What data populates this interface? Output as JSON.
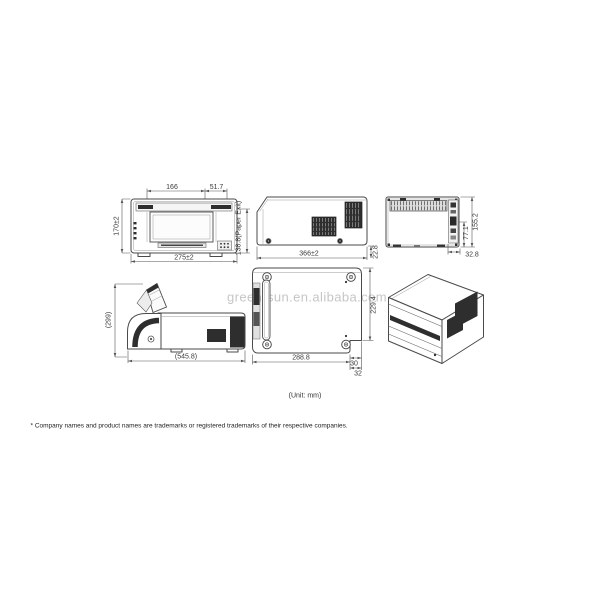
{
  "watermark": "green-sun.en.alibaba.com",
  "unit_label": "(Unit: mm)",
  "footnote": "* Company names and product names are trademarks or registered trademarks of their respective companies.",
  "views": {
    "front": {
      "dims": {
        "opening_width": "166",
        "opening_right": "51.7",
        "height": "170±2",
        "width": "275±2",
        "paper_exit": "138.8(Paper Exit)"
      }
    },
    "side": {
      "dims": {
        "depth": "366±2",
        "rear_step": "22.8"
      }
    },
    "rear": {
      "dims": {
        "height": "155.2",
        "connector": "77.1",
        "side_step": "32.8"
      }
    },
    "side_open": {
      "dims": {
        "height": "(299)",
        "depth": "(545.8)"
      }
    },
    "bottom": {
      "dims": {
        "depth": "229.4",
        "width": "288.8",
        "notch_a": "30",
        "notch_b": "32"
      }
    }
  },
  "colors": {
    "line": "#4a4a4a",
    "dark_fill": "#2e2e2e",
    "dim_text": "#3a3a3a",
    "watermark": "#c6c6c6"
  }
}
